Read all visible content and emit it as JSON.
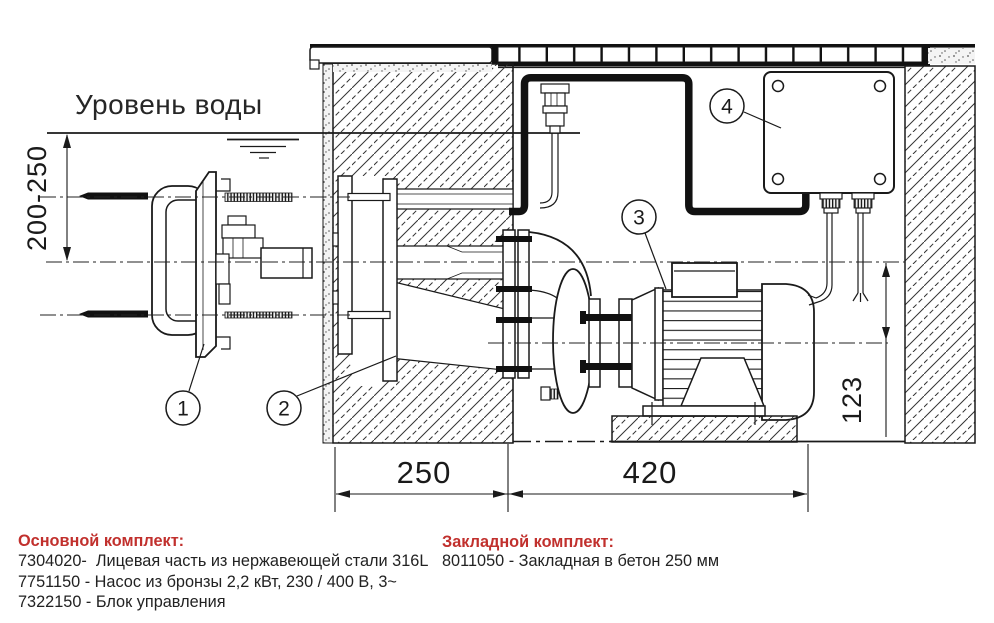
{
  "drawing": {
    "water_level_label": "Уровень воды",
    "dimensions": {
      "vertical_left": "200-250",
      "bottom_left": "250",
      "bottom_right": "420",
      "right_axis": "123"
    },
    "callouts": [
      "1",
      "2",
      "3",
      "4"
    ]
  },
  "legend": {
    "main_kit": {
      "header": "Основной комплект:",
      "items": [
        "7304020-  Лицевая часть из нержавеющей стали 316L",
        "7751150 - Насос из бронзы 2,2 кВт, 230 / 400 В, 3~",
        "7322150 - Блок управления"
      ]
    },
    "embedded_kit": {
      "header": "Закладной комплект:",
      "items": [
        "8011050 - Закладная в бетон 250 мм"
      ]
    }
  },
  "colors": {
    "accent_red": "#c1302d",
    "ink": "#1a1a1a"
  }
}
